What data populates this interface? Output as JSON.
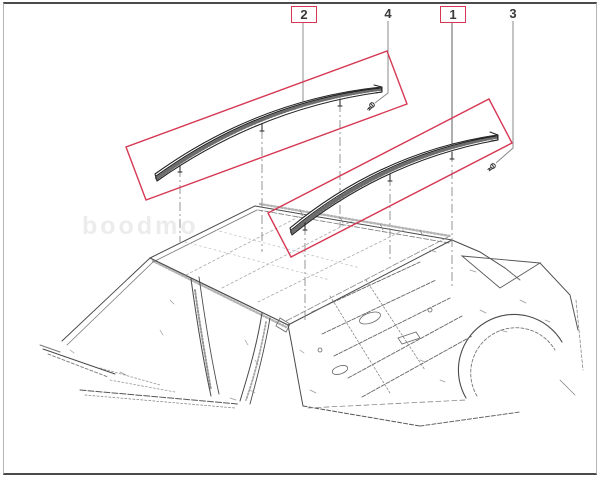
{
  "diagram": {
    "watermark": "boodmo",
    "highlight_color": "#d63853",
    "callouts": [
      {
        "label": "2",
        "highlighted": true
      },
      {
        "label": "4",
        "highlighted": false
      },
      {
        "label": "1",
        "highlighted": true
      },
      {
        "label": "3",
        "highlighted": false
      }
    ]
  }
}
